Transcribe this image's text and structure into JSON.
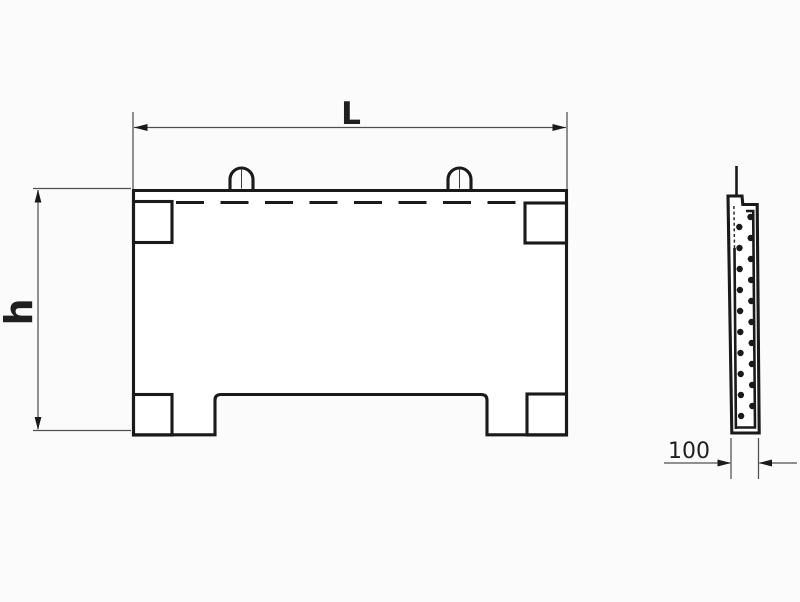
{
  "drawing": {
    "dimension_labels": {
      "length": "L",
      "height": "h",
      "thickness": "100"
    },
    "colors": {
      "outline": "#1a1a1a",
      "dimension_line": "#4f4f4f",
      "text": "#1f1f1f",
      "background": "#fbfbfb",
      "panel_fill": "#ffffff"
    },
    "front_view": {
      "lifting_loops": 2,
      "corner_plates": 4,
      "has_bottom_notch": true,
      "has_hidden_top_edge": true
    },
    "side_view": {
      "rebar_dots_left_column": 10,
      "rebar_dots_right_column": 10,
      "has_hidden_edge": true,
      "has_lifting_loop_edge": true
    }
  }
}
